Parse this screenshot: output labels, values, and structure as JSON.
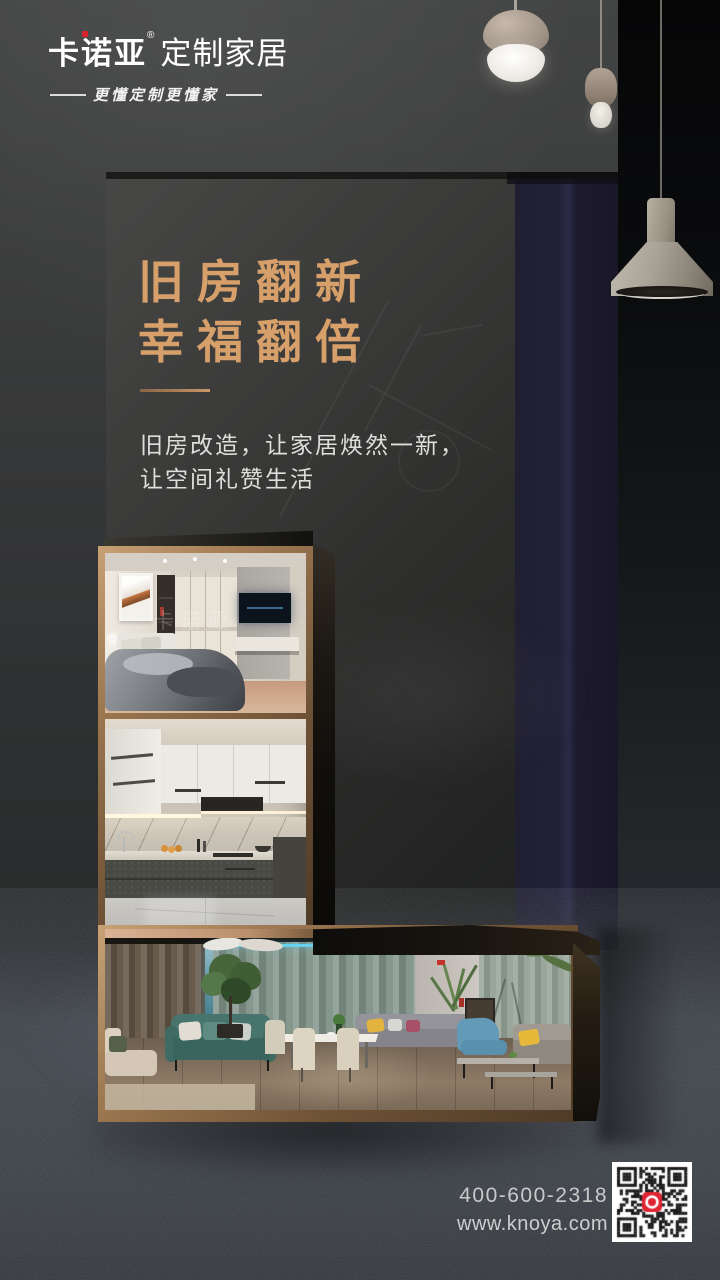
{
  "brand": {
    "name": "卡诺亚",
    "reg_mark": "®",
    "suffix": "定制家居",
    "tagline": "更懂定制更懂家"
  },
  "hero": {
    "title_line1": "旧房翻新",
    "title_line2": "幸福翻倍",
    "desc_line1": "旧房改造，让家居焕然一新，",
    "desc_line2": "让空间礼赞生活"
  },
  "photos": {
    "bedroom_watermark": "卡诺亚"
  },
  "contact": {
    "phone": "400-600-2318",
    "website": "www.knoya.com"
  },
  "icons": {
    "qr": "qr-code",
    "logo_dot": "red-square-dot",
    "lamp1": "acorn-pendant-lamp",
    "lamp2": "small-acorn-pendant-lamp",
    "lamp3": "industrial-pendant-lamp"
  },
  "colors": {
    "title_gold": "#D7A06B",
    "brand_red": "#D8232F",
    "frame_bronze": "#A07A52",
    "curtain_navy": "#232138",
    "qr_logo_red": "#E02330"
  }
}
